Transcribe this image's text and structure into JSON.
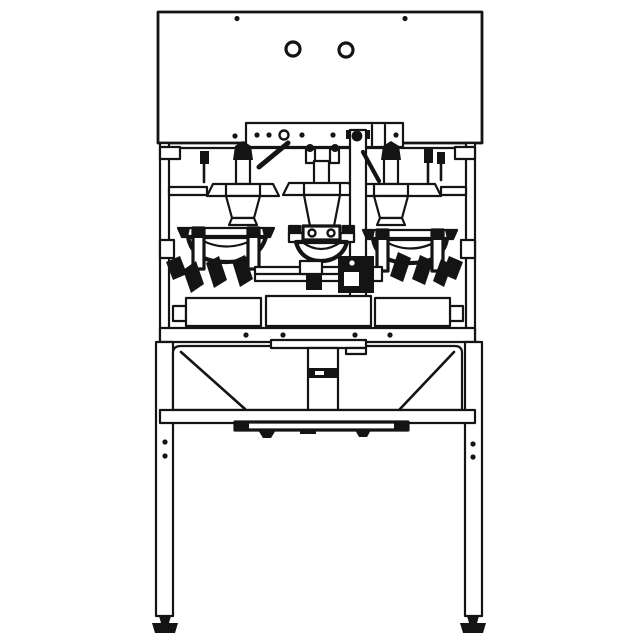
{
  "colors": {
    "paper": "#ffffff",
    "ink": "#141414"
  },
  "drawing": {
    "type": "technical-line-drawing-front-elevation",
    "machine": {
      "top_panel": {
        "round_holes": 2,
        "corner_bolts": 2
      },
      "mount_bracket": {
        "bolt_dots": 5,
        "pivot_circles": 2
      },
      "filling_heads": 3,
      "weigh_bowls": 3,
      "base_platform_sections": 3,
      "rail_bolts": 4,
      "funnel": {
        "center_chute": 1,
        "discharge_plate": 1
      },
      "legs": {
        "visible": 2,
        "bolt_holes_each": 2,
        "leveling_feet": 2
      }
    }
  }
}
